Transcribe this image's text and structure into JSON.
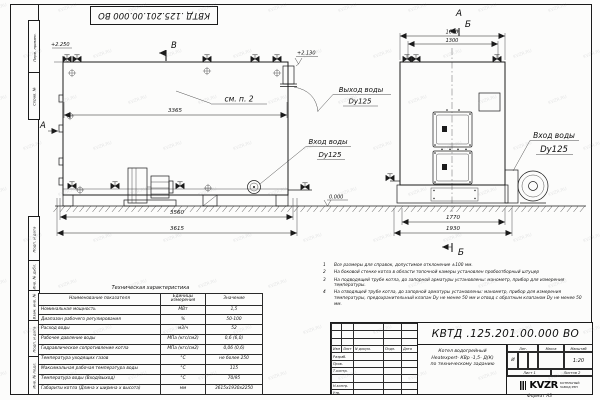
{
  "stamp": {
    "number": "КВТД .125.201.00.000  ВО"
  },
  "watermark": "KVZR.RU",
  "frame": {
    "side_labels": [
      "Перв. примен.",
      "Справ. №",
      "Подп. и дата",
      "Инв. № дубл.",
      "Взам. инв. №",
      "Подп. и дата",
      "Инв. № подл."
    ],
    "format_note": "Формат  А3"
  },
  "drawing": {
    "view_b": "В",
    "section_a_side": "А",
    "section_a_top": "А",
    "section_b_top": "Б",
    "section_b_bottom": "Б",
    "see_note": "см. п. 2",
    "elev_top_left": "+2.250",
    "elev_top_right": "+2.130",
    "elev_ground": "0.000",
    "dims": {
      "inner_length": "3365",
      "frame_length": "3560",
      "total_length": "3615",
      "front_top_outer": "1600",
      "front_top_inner": "1300",
      "front_bottom_inner": "1770",
      "front_bottom_outer": "1930"
    },
    "labels": {
      "water_outlet_1": "Выход воды",
      "water_outlet_2": "Dy125",
      "water_inlet_side_1": "Вход воды",
      "water_inlet_side_2": "Dy125",
      "water_inlet_front_1": "Вход воды",
      "water_inlet_front_2": "Dy125"
    }
  },
  "table": {
    "title": "Техническая характеристика",
    "col_headers": [
      "Наименование показателя",
      "Единицы измерения",
      "Значение"
    ],
    "rows": [
      [
        "Номинальная мощность",
        "МВт",
        "1,5"
      ],
      [
        "Диапазон рабочего регулирования",
        "%",
        "50-100"
      ],
      [
        "Расход воды",
        "м3/ч",
        "52"
      ],
      [
        "Рабочее давление воды",
        "МПа (кгс/см2)",
        "0,6 (6,0)"
      ],
      [
        "Гидравлическое сопротивление котла",
        "МПа (кгс/см2)",
        "0,06 (0,6)"
      ],
      [
        "Температура уходящих газов",
        "°С",
        "не более 250"
      ],
      [
        "Максимальная рабочая температура воды",
        "°С",
        "115"
      ],
      [
        "Температура воды (Вход/выход)",
        "°С",
        "70/95"
      ],
      [
        "Габариты котла (Длина х ширина х высота)",
        "мм",
        "3615х1930х2250"
      ]
    ]
  },
  "notes": {
    "items": [
      "Все размеры для справок, допустимое отклонение ±100 мм.",
      "На боковой стенке котла в области топочной камеры установлен пробоотборный штуцер",
      "На подводящей трубе котла, до запорной арматуры установлены: манометр, прибор для измерения температуры.",
      "На отводящей трубе котла, до запорной арматуры установлены: манометр, прибор для измерения температуры, предохранительный клапан Dy не менее 50 мм и отвод с обратным клапаном Dy не менее 50 мм."
    ]
  },
  "titleblock": {
    "doc_number": "КВТД .125.201.00.000  ВО",
    "product_name_lines": [
      "Котел водогрейный",
      "Heatexpert- КВр -1,5- Д(К)",
      "по техническому заданию"
    ],
    "header_cells": [
      "Изм",
      "Лист",
      "N докум.",
      "Подп.",
      "Дата"
    ],
    "row_labels": [
      "Разраб.",
      "Пров.",
      "Т.контр.",
      "Н.контр.",
      "Утв."
    ],
    "lit_label": "Лит.",
    "mass_label": "Масса",
    "scale_label": "Масштаб",
    "lit_value": "И",
    "scale_value": "1:20",
    "sheet_text": "Лист  1",
    "sheets_text": "Листов  2",
    "logo_text": "KVZR",
    "logo_sub1": "КОТЕЛЬНЫЙ",
    "logo_sub2": "ЗАВОД РЭП"
  }
}
